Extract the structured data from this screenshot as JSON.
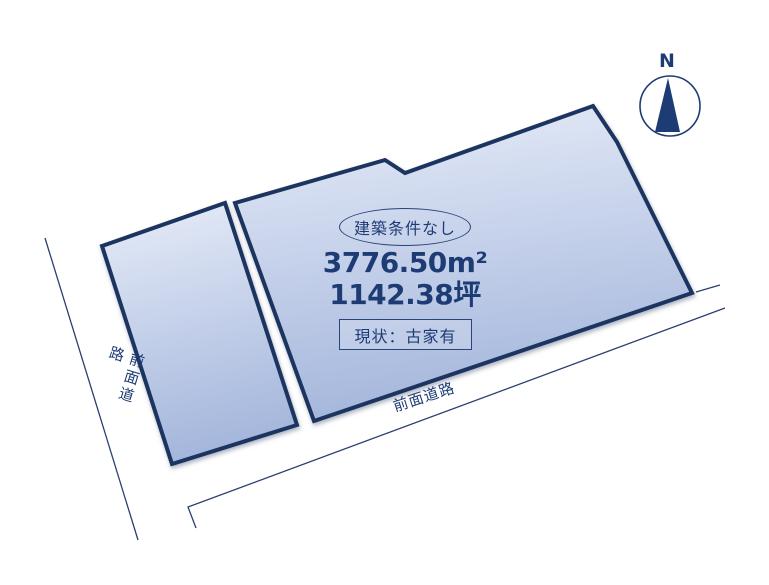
{
  "parcel": {
    "badge": "建築条件なし",
    "area_m2": "3776.50m²",
    "area_tsubo": "1142.38坪",
    "status": "現状：古家有"
  },
  "roads": {
    "left_label": "前面道路",
    "bottom_label": "前面道路"
  },
  "compass": {
    "north_label": "N"
  },
  "colors": {
    "navy_text": "#1e3c74",
    "parcel_border": "#1e3460",
    "parcel_fill_top": "#e7edf8",
    "parcel_fill_mid": "#c9d4ec",
    "parcel_fill_bottom": "#a5b7dc",
    "road_line": "#2b406e",
    "background": "#ffffff"
  }
}
